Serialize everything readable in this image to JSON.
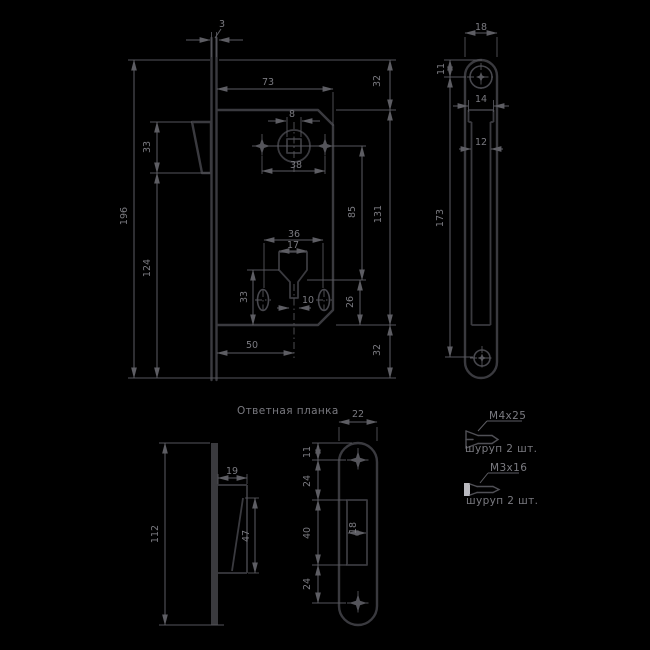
{
  "colors": {
    "background": "#000000",
    "part_outline": "#3a3a3f",
    "dimension_lines": "#5d5d63",
    "text": "#7a7a80"
  },
  "views": {
    "lock_front": {
      "dims": {
        "faceplate_thickness": "3",
        "faceplate_height": "196",
        "latch_height": "33",
        "latch_to_bottom": "124",
        "body_width": "73",
        "body_top_offset": "32",
        "spindle_square": "8",
        "handle_screw_span": "38",
        "hub_to_cylinder": "85",
        "body_height": "131",
        "cylinder_screw_span": "36",
        "cylinder_width": "17",
        "cylinder_to_bottom": "33",
        "slot_width": "10",
        "ovals_to_bottom": "26",
        "backset": "50",
        "body_bottom_offset": "32"
      }
    },
    "faceplate_side": {
      "dims": {
        "width": "18",
        "top_to_screw": "11",
        "body_top_width": "14",
        "body_width": "12",
        "screw_spacing": "173"
      }
    },
    "strike_front": {
      "title": "Ответная планка",
      "dims": {
        "width": "22",
        "top_to_screw": "11",
        "screw_to_slot": "24",
        "slot_height": "40",
        "slot_to_screw": "24",
        "slot_width": "18"
      }
    },
    "strike_side": {
      "dims": {
        "height": "112",
        "depth": "19",
        "tongue_length": "47"
      }
    },
    "hardware": {
      "screw1": {
        "size": "M4x25",
        "qty": "шуруп 2 шт."
      },
      "screw2": {
        "size": "M3x16",
        "qty": "шуруп 2 шт."
      }
    }
  }
}
